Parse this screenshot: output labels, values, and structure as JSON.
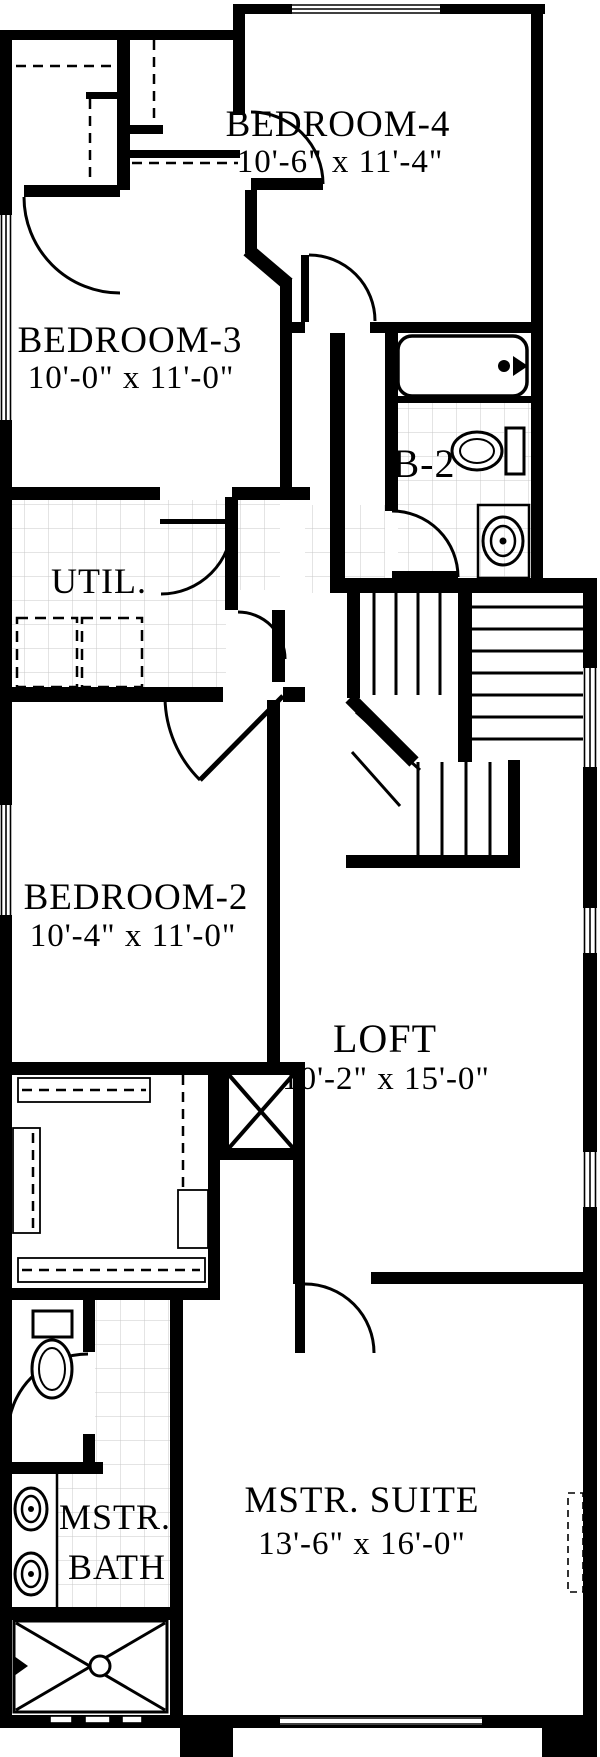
{
  "plan": {
    "type": "floor-plan",
    "colors": {
      "wall": "#000000",
      "background": "#ffffff",
      "tile_line": "#c9c9c9"
    },
    "rooms": {
      "bedroom4": {
        "name": "BEDROOM-4",
        "dims": "10'-6\" x 11'-4\""
      },
      "bedroom3": {
        "name": "BEDROOM-3",
        "dims": "10'-0\" x 11'-0\""
      },
      "bedroom2": {
        "name": "BEDROOM-2",
        "dims": "10'-4\" x 11'-0\""
      },
      "loft": {
        "name": "LOFT",
        "dims": "10'-2\" x 15'-0\""
      },
      "master_suite": {
        "name": "MSTR. SUITE",
        "dims": "13'-6\" x 16'-0\""
      },
      "utility": {
        "name": "UTIL."
      },
      "bath2": {
        "name": "B-2"
      },
      "master_bath": {
        "line1": "MSTR.",
        "line2": "BATH"
      }
    },
    "fixtures": [
      "bathtub",
      "toilet",
      "vanity-sink",
      "washer",
      "dryer",
      "staircase",
      "chase",
      "master-toilet",
      "double-vanity",
      "shower"
    ]
  }
}
